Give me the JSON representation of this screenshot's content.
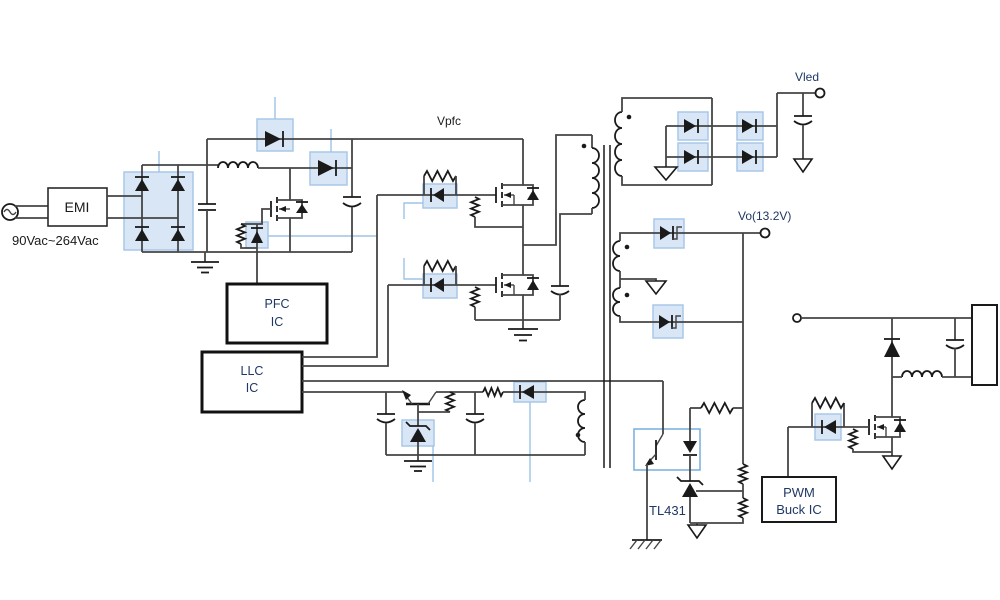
{
  "diagram": {
    "title": "AC-DC LED driver power supply schematic",
    "labels": {
      "ac_input": "90Vac~264Vac",
      "emi": "EMI",
      "vpfc": "Vpfc",
      "vled": "Vled",
      "vo": "Vo(13.2V)",
      "tl431": "TL431",
      "pfc_ic_line1": "PFC",
      "pfc_ic_line2": "IC",
      "llc_ic_line1": "LLC",
      "llc_ic_line2": "IC",
      "pwm_line1": "PWM",
      "pwm_line2": "Buck IC"
    },
    "colors": {
      "wire": "#454545",
      "component": "#1a1a1a",
      "highlight_fill": "#d9e6f6",
      "highlight_stroke": "#a9c7e8",
      "callout": "#9dc3e6",
      "label_dark": "#1a1a1a",
      "label_navy": "#1f3864",
      "background": "#ffffff"
    }
  }
}
